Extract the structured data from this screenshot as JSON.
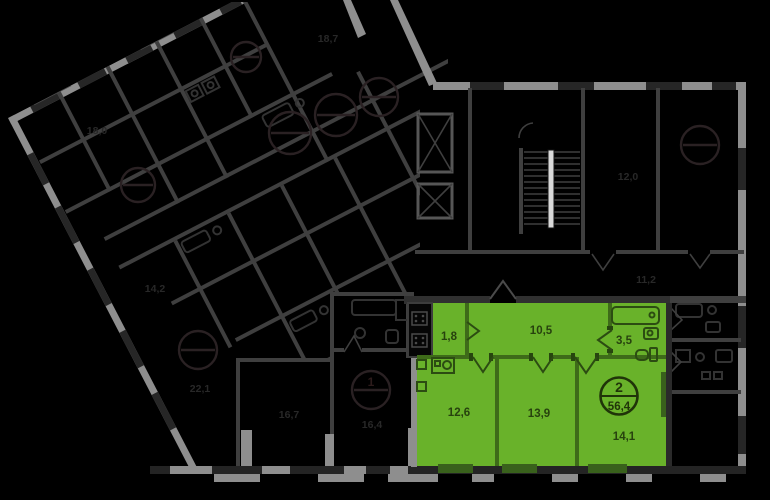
{
  "plan": {
    "type": "residential-floor-plan",
    "background_color": "#000000",
    "highlight_color": "#69b22a",
    "dim_wall_color": "#8e8e8e"
  },
  "selected_apartment": {
    "badge": {
      "rooms": "2",
      "total_area": "56,4"
    },
    "rooms": [
      {
        "name": "wardrobe",
        "area": "1,8"
      },
      {
        "name": "hallway",
        "area": "10,5"
      },
      {
        "name": "bathroom",
        "area": "3,5"
      },
      {
        "name": "kitchen",
        "area": "12,6"
      },
      {
        "name": "room-1",
        "area": "13,9"
      },
      {
        "name": "room-2",
        "area": "14,1"
      }
    ]
  },
  "dim_badge": {
    "rooms": "1"
  },
  "dim_labels": [
    {
      "area": "18,0"
    },
    {
      "area": "18,7"
    },
    {
      "area": "14,2"
    },
    {
      "area": "22,1"
    },
    {
      "area": "16,7"
    },
    {
      "area": "16,4"
    },
    {
      "area": "12,0"
    },
    {
      "area": "11,2"
    }
  ]
}
